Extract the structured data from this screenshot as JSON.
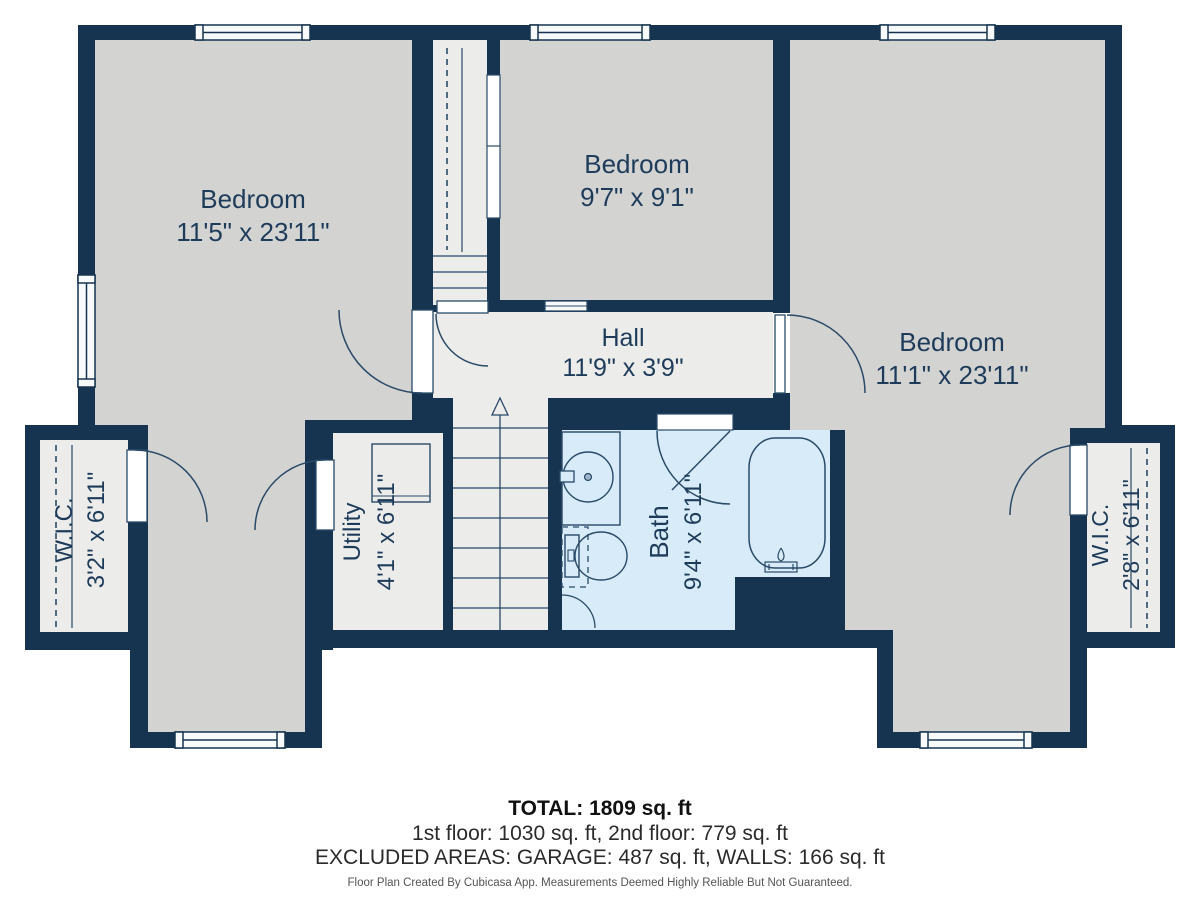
{
  "plan": {
    "rooms": [
      {
        "name": "Bedroom",
        "dims": "11'5\" x 23'11\""
      },
      {
        "name": "Bedroom",
        "dims": "9'7\" x 9'1\""
      },
      {
        "name": "Bedroom",
        "dims": "11'1\" x 23'11\""
      },
      {
        "name": "Hall",
        "dims": "11'9\" x 3'9\""
      },
      {
        "name": "W.I.C.",
        "dims": "3'2\" x 6'11\""
      },
      {
        "name": "Utility",
        "dims": "4'1\" x 6'11\""
      },
      {
        "name": "Bath",
        "dims": "9'4\" x 6'11\""
      },
      {
        "name": "W.I.C.",
        "dims": "2'8\" x 6'11\""
      }
    ],
    "colors": {
      "wall": "#163450",
      "bedroom_fill": "#d3d3d2",
      "light_fill": "#ececeb",
      "bath_fill": "#d7ecf8",
      "fixture_line": "#2a4a68",
      "label_text": "#1e3c5a"
    }
  },
  "footer": {
    "total": "TOTAL: 1809 sq. ft",
    "floors": "1st floor: 1030 sq. ft, 2nd floor: 779 sq. ft",
    "excluded": "EXCLUDED AREAS: GARAGE: 487 sq. ft, WALLS: 166 sq. ft",
    "disclaimer": "Floor Plan Created By Cubicasa App. Measurements Deemed Highly Reliable But Not Guaranteed."
  }
}
